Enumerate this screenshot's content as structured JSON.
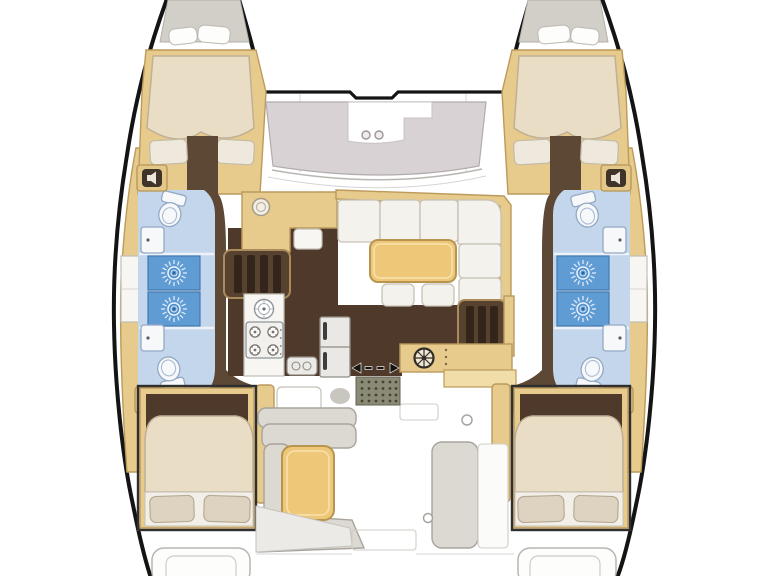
{
  "title": "catamaran-floorplan",
  "colors": {
    "outline": "#141414",
    "wood": "#e7cb8c",
    "wood_dark": "#bb9a5c",
    "wood_light": "#f0dda8",
    "floor_dark": "#4f392a",
    "corridor": "#5d4836",
    "bed": "#e9ddc6",
    "bed_stroke": "#bfb096",
    "pillow": "#efe9dd",
    "bench": "#dcd8d2",
    "bench_front": "#d9d2d5",
    "locker": "#d2cec8",
    "bath_floor": "#c4d6ec",
    "shower": "#5f9cd4",
    "shower_dark": "#4479ae",
    "sofa": "#f4f2ec",
    "table": "#eec878",
    "fridge": "#e9e8e4",
    "mat": "#8b8a76",
    "line": "#b9b6b1",
    "white_fix": "#f7f6f3"
  },
  "vessel": {
    "type": "catamaran",
    "view": "deck plan",
    "hulls": 2
  },
  "areas": {
    "port_hull": {
      "bow_locker": true,
      "forward_cabin": {
        "double_berth": true,
        "pillows": 2
      },
      "forward_head": {
        "toilet": true,
        "sink": true
      },
      "shower_stalls": 2,
      "aft_head": {
        "toilet": true,
        "sink": true
      },
      "aft_cabin": {
        "double_berth": true,
        "pillows": 2
      },
      "companionway_steps": 1,
      "speaker_hatches": 2
    },
    "starboard_hull": {
      "bow_locker": true,
      "forward_cabin": {
        "double_berth": true,
        "pillows": 2
      },
      "forward_head": {
        "toilet": true,
        "sink": true
      },
      "shower_stalls": 2,
      "aft_head": {
        "toilet": true,
        "sink": true
      },
      "aft_cabin": {
        "double_berth": true,
        "pillows": 2
      },
      "companionway_steps": 1,
      "speaker_hatches": 2
    },
    "saloon": {
      "forward_cockpit_seat": {
        "cupholders": 2
      },
      "galley": {
        "counter": true,
        "round_sinks": 2,
        "stove_burners": 4,
        "oven": true,
        "refrigerator": true,
        "seat": true
      },
      "dinette": {
        "l_sofa_sections": 6,
        "table": true,
        "ottomans": 2
      },
      "nav_station": {
        "helm_wheel": true,
        "chart_desk": true
      },
      "entry": {
        "sliding_door": true,
        "floor_mat_grid": true
      }
    },
    "cockpit": {
      "table": true,
      "benches": 3,
      "shelf": true,
      "cupholder_rings": 2
    },
    "transom": {
      "swim_platforms": 2
    }
  },
  "icons": [
    "shower-rose-icon",
    "toilet-icon",
    "sink-icon",
    "speaker-icon",
    "burner-icon",
    "helm-wheel-icon",
    "round-sink-icon",
    "sliding-door-arrows-icon",
    "floor-mat-grid-icon",
    "cupholder-icon"
  ]
}
